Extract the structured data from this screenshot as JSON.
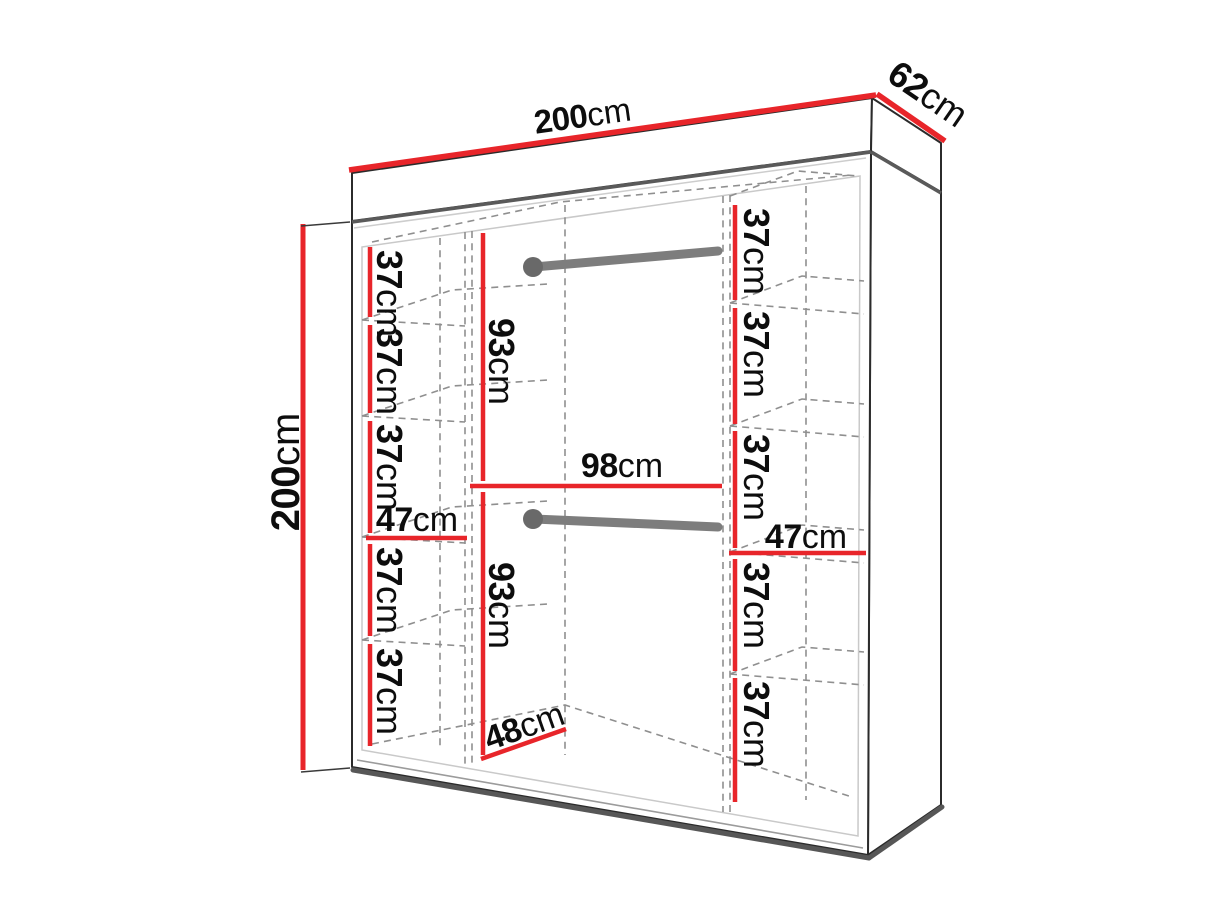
{
  "meta": {
    "description": "Wardrobe interior dimension diagram",
    "units": "cm",
    "accent_color": "#e8252a",
    "outline_color": "#2b2b2b",
    "rail_color": "#7d7d7d"
  },
  "overall": {
    "width": {
      "value": "200",
      "unit": "cm"
    },
    "depth": {
      "value": "62",
      "unit": "cm"
    },
    "height": {
      "value": "200",
      "unit": "cm"
    }
  },
  "left_column": {
    "width": {
      "value": "47",
      "unit": "cm"
    },
    "shelves": [
      {
        "value": "37",
        "unit": "cm"
      },
      {
        "value": "37",
        "unit": "cm"
      },
      {
        "value": "37",
        "unit": "cm"
      },
      {
        "value": "37",
        "unit": "cm"
      },
      {
        "value": "37",
        "unit": "cm"
      }
    ]
  },
  "middle_section": {
    "upper_height": {
      "value": "93",
      "unit": "cm"
    },
    "width": {
      "value": "98",
      "unit": "cm"
    },
    "lower_height": {
      "value": "93",
      "unit": "cm"
    },
    "depth": {
      "value": "48",
      "unit": "cm"
    }
  },
  "right_column": {
    "width": {
      "value": "47",
      "unit": "cm"
    },
    "shelves": [
      {
        "value": "37",
        "unit": "cm"
      },
      {
        "value": "37",
        "unit": "cm"
      },
      {
        "value": "37",
        "unit": "cm"
      },
      {
        "value": "37",
        "unit": "cm"
      },
      {
        "value": "37",
        "unit": "cm"
      }
    ]
  }
}
